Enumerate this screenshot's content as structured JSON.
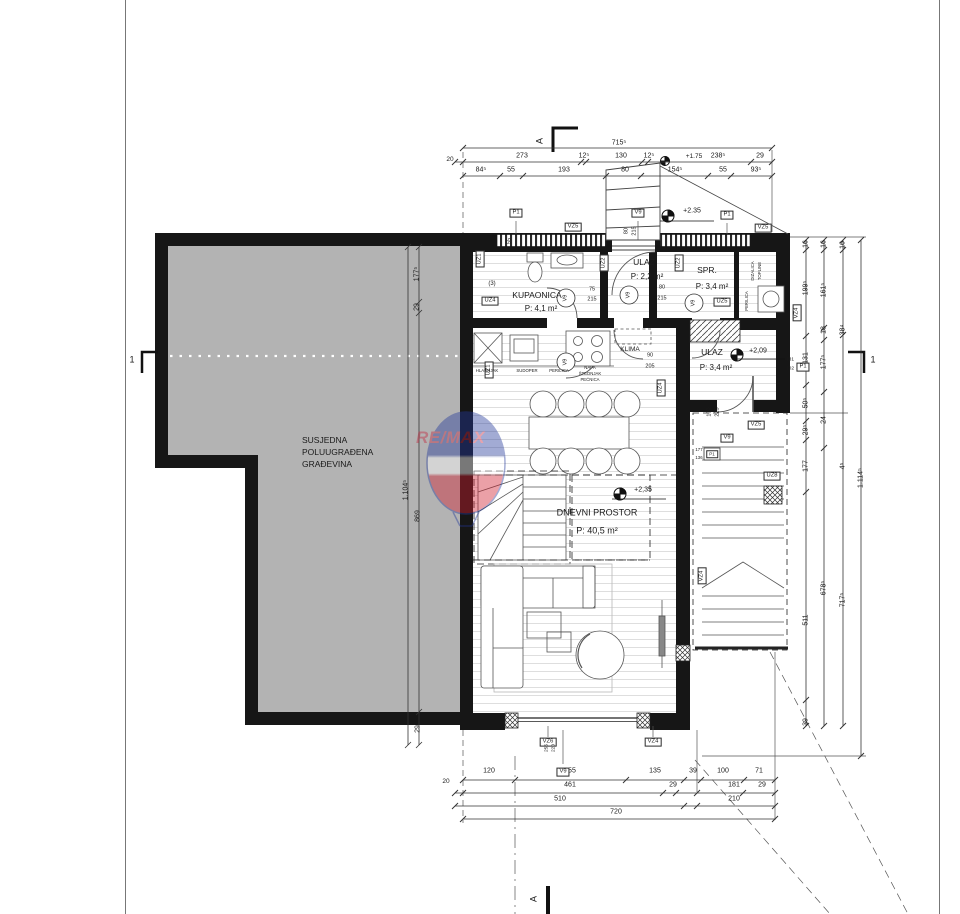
{
  "watermark": {
    "text": "RE/MAX"
  },
  "colors": {
    "wall": "#161616",
    "neighbor_fill": "#b3b3b3",
    "watermark_blue": "#24399b",
    "watermark_red": "#d01f2f",
    "line": "#555555"
  },
  "labels": {
    "dims_top": [
      {
        "t": "715⁵",
        "x": 619,
        "y": 143
      },
      {
        "t": "20",
        "x": 450,
        "y": 160,
        "fs": 6.5
      },
      {
        "t": "273",
        "x": 522,
        "y": 156
      },
      {
        "t": "12⁵",
        "x": 584,
        "y": 156
      },
      {
        "t": "130",
        "x": 621,
        "y": 156
      },
      {
        "t": "12⁵",
        "x": 649,
        "y": 156
      },
      {
        "t": "+1.75",
        "x": 694,
        "y": 157,
        "fs": 6.5
      },
      {
        "t": "238⁵",
        "x": 718,
        "y": 156
      },
      {
        "t": "29",
        "x": 760,
        "y": 156
      },
      {
        "t": "84⁵",
        "x": 481,
        "y": 170
      },
      {
        "t": "55",
        "x": 511,
        "y": 170
      },
      {
        "t": "193",
        "x": 564,
        "y": 170
      },
      {
        "t": "80",
        "x": 625,
        "y": 170
      },
      {
        "t": "154⁵",
        "x": 675,
        "y": 170
      },
      {
        "t": "55",
        "x": 723,
        "y": 170
      },
      {
        "t": "93⁵",
        "x": 756,
        "y": 170
      }
    ],
    "dims_bottom": [
      {
        "t": "120",
        "x": 489,
        "y": 771
      },
      {
        "t": "255",
        "x": 570,
        "y": 771
      },
      {
        "t": "135",
        "x": 655,
        "y": 771
      },
      {
        "t": "39",
        "x": 693,
        "y": 771
      },
      {
        "t": "100",
        "x": 723,
        "y": 771
      },
      {
        "t": "71",
        "x": 759,
        "y": 771
      },
      {
        "t": "20",
        "x": 446,
        "y": 782,
        "fs": 6.5
      },
      {
        "t": "461",
        "x": 570,
        "y": 785
      },
      {
        "t": "29",
        "x": 673,
        "y": 785
      },
      {
        "t": "181",
        "x": 734,
        "y": 785
      },
      {
        "t": "29",
        "x": 762,
        "y": 785
      },
      {
        "t": "510",
        "x": 560,
        "y": 799
      },
      {
        "t": "210",
        "x": 734,
        "y": 799
      },
      {
        "t": "720",
        "x": 616,
        "y": 812
      }
    ],
    "dims_right": [
      {
        "t": "16",
        "x": 806,
        "y": 244
      },
      {
        "t": "199⁵",
        "x": 806,
        "y": 288
      },
      {
        "t": "131",
        "x": 806,
        "y": 358
      },
      {
        "t": "50⁵",
        "x": 806,
        "y": 403
      },
      {
        "t": "29⁵",
        "x": 806,
        "y": 430
      },
      {
        "t": "177",
        "x": 806,
        "y": 466
      },
      {
        "t": "511",
        "x": 806,
        "y": 620
      },
      {
        "t": "39",
        "x": 806,
        "y": 722
      },
      {
        "t": "16",
        "x": 824,
        "y": 244
      },
      {
        "t": "161⁵",
        "x": 824,
        "y": 290
      },
      {
        "t": "18",
        "x": 824,
        "y": 330
      },
      {
        "t": "177⁵",
        "x": 824,
        "y": 362
      },
      {
        "t": "24",
        "x": 824,
        "y": 420
      },
      {
        "t": "678⁵",
        "x": 824,
        "y": 588
      },
      {
        "t": "16",
        "x": 843,
        "y": 245
      },
      {
        "t": "38⁴",
        "x": 843,
        "y": 330
      },
      {
        "t": "4⁵",
        "x": 843,
        "y": 466
      },
      {
        "t": "717⁵",
        "x": 843,
        "y": 600
      },
      {
        "t": "1.114⁵",
        "x": 861,
        "y": 478
      }
    ],
    "dims_neighbor": [
      {
        "t": "177⁵",
        "x": 417,
        "y": 274
      },
      {
        "t": "29",
        "x": 417,
        "y": 307
      },
      {
        "t": "869",
        "x": 418,
        "y": 516
      },
      {
        "t": "29",
        "x": 418,
        "y": 729
      },
      {
        "t": "1.104⁵",
        "x": 406,
        "y": 490
      }
    ],
    "rooms": [
      {
        "t": "KUPAONICA",
        "x": 537,
        "y": 295
      },
      {
        "t": "P: 4,1 m²",
        "x": 541,
        "y": 309,
        "fs": 8
      },
      {
        "t": "ULAZ",
        "x": 644,
        "y": 262
      },
      {
        "t": "P: 2,2 m²",
        "x": 647,
        "y": 277,
        "fs": 8
      },
      {
        "t": "SPR.",
        "x": 707,
        "y": 270
      },
      {
        "t": "P: 3,4 m²",
        "x": 712,
        "y": 287,
        "fs": 8
      },
      {
        "t": "ULAZ",
        "x": 712,
        "y": 352
      },
      {
        "t": "P: 3,4 m²",
        "x": 716,
        "y": 368,
        "fs": 8
      },
      {
        "t": "DNEVNI PROSTOR",
        "x": 597,
        "y": 513,
        "fs": 9
      },
      {
        "t": "P: 40,5 m²",
        "x": 597,
        "y": 531,
        "fs": 9
      },
      {
        "t": "KLIMA",
        "x": 630,
        "y": 350,
        "fs": 6.5
      }
    ],
    "texts": [
      {
        "t": "SUSJEDNA",
        "x": 302,
        "y": 440,
        "a": "left"
      },
      {
        "t": "POLUUGRAĐENA",
        "x": 302,
        "y": 452,
        "a": "left"
      },
      {
        "t": "GRAĐEVINA",
        "x": 302,
        "y": 464,
        "a": "left"
      }
    ],
    "boxes": [
      {
        "t": "P1",
        "x": 516,
        "y": 213
      },
      {
        "t": "VZ5",
        "x": 573,
        "y": 227
      },
      {
        "t": "V9",
        "x": 638,
        "y": 213
      },
      {
        "t": "P1",
        "x": 727,
        "y": 215
      },
      {
        "t": "VZ5",
        "x": 763,
        "y": 228
      },
      {
        "t": "UZ4",
        "x": 490,
        "y": 301
      },
      {
        "t": "UZ5",
        "x": 722,
        "y": 302
      },
      {
        "t": "V9",
        "x": 727,
        "y": 438
      },
      {
        "t": "VZ5",
        "x": 756,
        "y": 425
      },
      {
        "t": "UZ8",
        "x": 772,
        "y": 476
      },
      {
        "t": "P1",
        "x": 803,
        "y": 367
      },
      {
        "t": "P1",
        "x": 712,
        "y": 454,
        "fs": 4.5
      },
      {
        "t": "VZ6",
        "x": 548,
        "y": 742
      },
      {
        "t": "VZ4",
        "x": 653,
        "y": 742
      },
      {
        "t": "V9",
        "x": 563,
        "y": 772
      }
    ],
    "vboxes": [
      {
        "t": "UZ1",
        "x": 480,
        "y": 259
      },
      {
        "t": "UZ2",
        "x": 604,
        "y": 263
      },
      {
        "t": "UZ2",
        "x": 679,
        "y": 263
      },
      {
        "t": "UZ1",
        "x": 489,
        "y": 370
      },
      {
        "t": "UZ4",
        "x": 661,
        "y": 388
      },
      {
        "t": "VZ4",
        "x": 797,
        "y": 313
      },
      {
        "t": "VZ4",
        "x": 702,
        "y": 576
      }
    ],
    "circles": [
      {
        "t": "V9",
        "x": 566,
        "y": 298
      },
      {
        "t": "V9",
        "x": 629,
        "y": 295
      },
      {
        "t": "V9",
        "x": 694,
        "y": 303
      },
      {
        "t": "V9",
        "x": 566,
        "y": 362
      }
    ],
    "small": [
      {
        "t": "75",
        "x": 592,
        "y": 290
      },
      {
        "t": "215",
        "x": 592,
        "y": 300
      },
      {
        "t": "80",
        "x": 662,
        "y": 288
      },
      {
        "t": "215",
        "x": 662,
        "y": 299
      },
      {
        "t": "90",
        "x": 650,
        "y": 356
      },
      {
        "t": "205",
        "x": 650,
        "y": 367
      },
      {
        "t": "131",
        "x": 790,
        "y": 361,
        "fs": 4.8
      },
      {
        "t": "102",
        "x": 790,
        "y": 370,
        "fs": 4.8
      },
      {
        "t": "177",
        "x": 699,
        "y": 450,
        "fs": 4.3
      },
      {
        "t": "136",
        "x": 699,
        "y": 458,
        "fs": 4.3
      },
      {
        "t": "(3)",
        "x": 492,
        "y": 284,
        "fs": 6
      }
    ],
    "smallr": [
      {
        "t": "80",
        "x": 627,
        "y": 231
      },
      {
        "t": "215",
        "x": 635,
        "y": 231
      },
      {
        "t": "55",
        "x": 510,
        "y": 241
      },
      {
        "t": "100",
        "x": 710,
        "y": 412
      },
      {
        "t": "223",
        "x": 718,
        "y": 412
      },
      {
        "t": "255",
        "x": 548,
        "y": 748,
        "fs": 4.8
      },
      {
        "t": "220",
        "x": 555,
        "y": 748,
        "fs": 4.8
      }
    ],
    "tiny": [
      {
        "t": "HLADNJAK",
        "x": 487,
        "y": 371
      },
      {
        "t": "SUDOPER",
        "x": 527,
        "y": 371
      },
      {
        "t": "PERILICA",
        "x": 559,
        "y": 371
      },
      {
        "t": "NAPA",
        "x": 590,
        "y": 368
      },
      {
        "t": "ŠTEDNJAK",
        "x": 590,
        "y": 374
      },
      {
        "t": "PEĆNICA",
        "x": 590,
        "y": 380
      }
    ],
    "tinyr": [
      {
        "t": "DIZALICA",
        "x": 753,
        "y": 271
      },
      {
        "t": "TOPLINE",
        "x": 760,
        "y": 271
      },
      {
        "t": "PERILICA",
        "x": 747,
        "y": 301
      }
    ],
    "elev": [
      {
        "t": "+2.35",
        "x": 692,
        "y": 211
      },
      {
        "t": "+2,09",
        "x": 758,
        "y": 351
      },
      {
        "t": "+2,35",
        "x": 643,
        "y": 490
      }
    ],
    "sections": [
      {
        "t": "1",
        "x": 132,
        "y": 360
      },
      {
        "t": "1",
        "x": 873,
        "y": 360
      },
      {
        "t": "A",
        "x": 540,
        "y": 141,
        "r": 1
      },
      {
        "t": "A",
        "x": 534,
        "y": 899,
        "r": 1
      }
    ]
  }
}
